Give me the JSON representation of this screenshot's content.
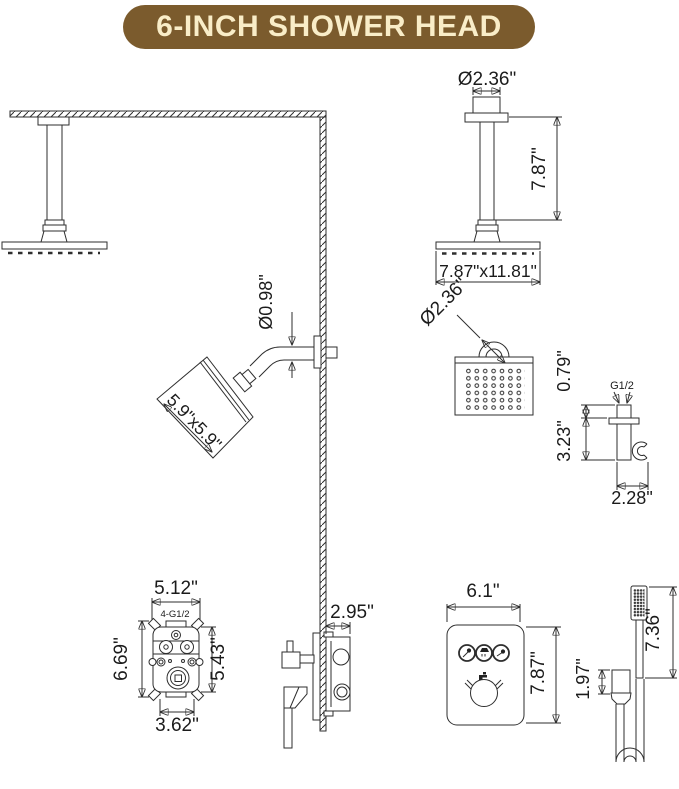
{
  "title": "6-INCH SHOWER HEAD",
  "colors": {
    "banner_bg": "#7b5b2d",
    "banner_text": "#f9edc8",
    "line": "#2e2e2e",
    "background": "#ffffff"
  },
  "ceiling_mount_detail": {
    "arm_diameter": "Ø2.36\"",
    "arm_length": "7.87\"",
    "head_size": "7.87\"x11.81\""
  },
  "head_face_detail": {
    "inlet_diameter": "Ø2.36\""
  },
  "wall_shower": {
    "arm_diameter": "Ø0.98\"",
    "head_size": "5.9\"x5.9\""
  },
  "hand_shower_holder": {
    "thread": "G1/2",
    "stub_height": "0.79\"",
    "body_height": "3.23\"",
    "depth": "2.28\""
  },
  "valve_front": {
    "overall_width": "5.12\"",
    "ports_label": "4-G1/2",
    "overall_height": "6.69\"",
    "body_height": "5.43\"",
    "body_width": "3.62\""
  },
  "valve_side": {
    "depth": "2.95\""
  },
  "trim_plate": {
    "width": "6.1\"",
    "height": "7.87\""
  },
  "hand_shower": {
    "wand_length": "7.36\"",
    "bracket_height": "1.97\""
  }
}
